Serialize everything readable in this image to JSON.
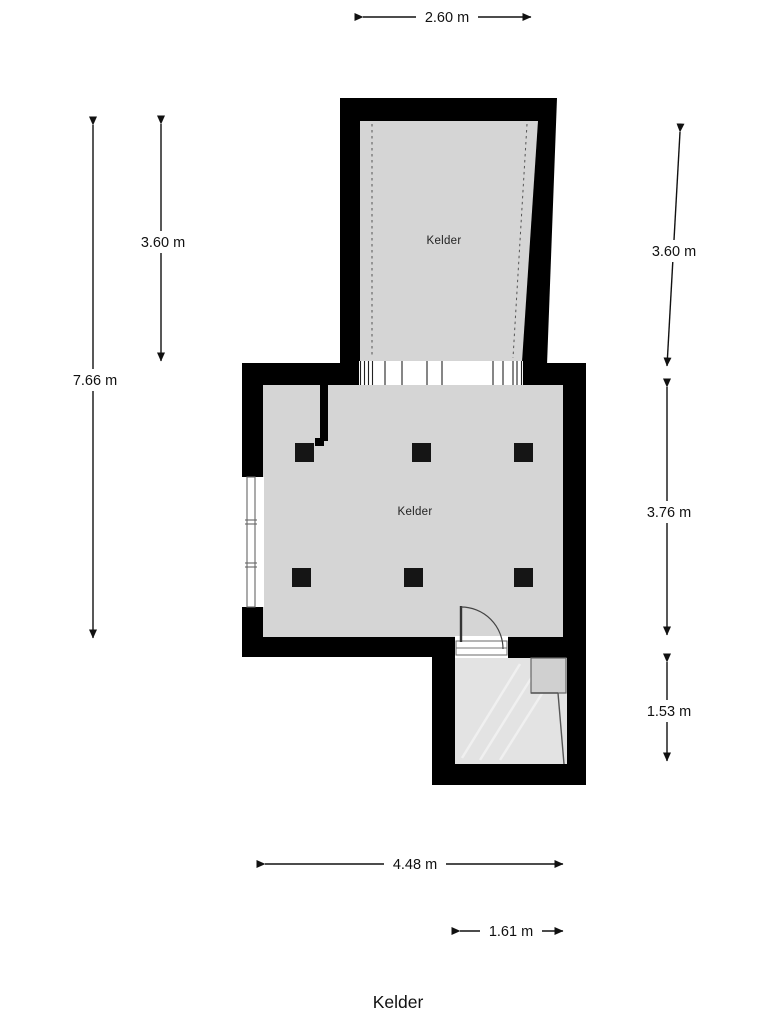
{
  "page_title": "Kelder",
  "plan": {
    "upper_room": {
      "label": "Kelder"
    },
    "main_room": {
      "label": "Kelder"
    },
    "dimensions": {
      "top_width": "2.60 m",
      "total_height_left": "7.66 m",
      "upper_height_left": "3.60 m",
      "upper_height_right": "3.60 m",
      "main_height_right": "3.76 m",
      "lower_height_right": "1.53 m",
      "main_width_bottom": "4.48 m",
      "lower_width_bottom": "1.61 m"
    },
    "colors": {
      "wall": "#000000",
      "floor_upper": "#d5d5d5",
      "floor_main": "#d5d5d5",
      "floor_lower": "#e3e3e3",
      "floor_step": "#d0d0d0",
      "background": "#ffffff",
      "dimension_line": "#111111"
    }
  }
}
